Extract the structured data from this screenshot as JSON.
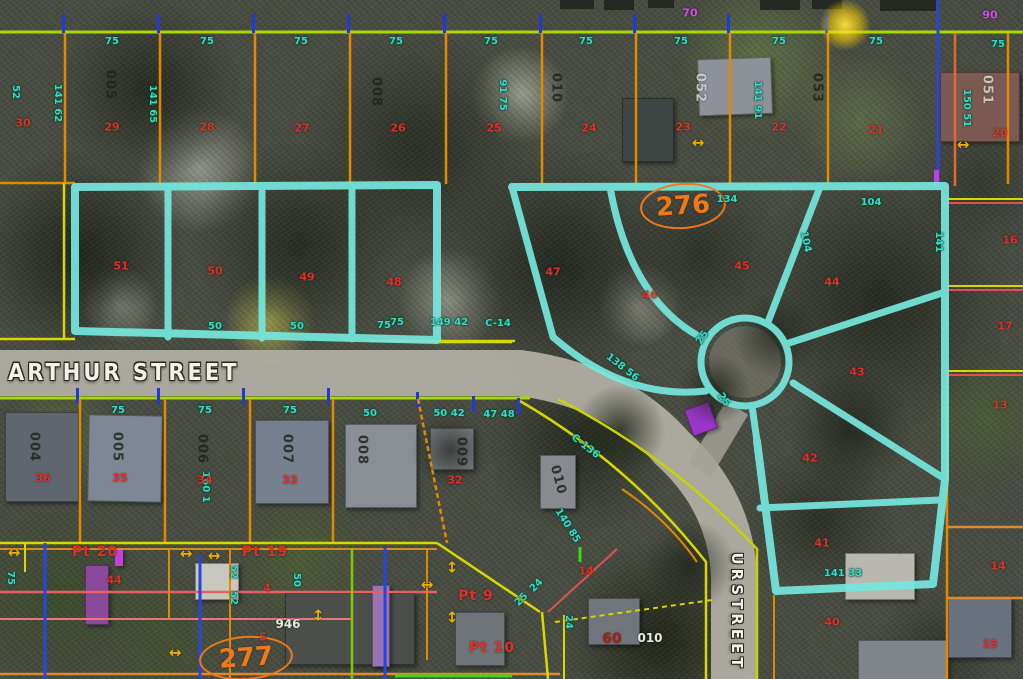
{
  "view": {
    "description": "GIS parcel map over aerial photo",
    "width": 1023,
    "height": 679
  },
  "colors": {
    "cyan_hl": "#76e8de",
    "line_orange": "#e08a00",
    "line_yellow": "#d8d800",
    "line_yellowgreen": "#a8d800",
    "line_red": "#e05050",
    "line_blue": "#2845e0",
    "text_cyan": "#3bd8cf",
    "text_red": "#e03028",
    "survey_orange": "#f07818",
    "text_purple": "#cc50e8",
    "street_gray": "#b3afa5"
  },
  "streets": {
    "arthur": "ARTHUR STREET",
    "vertical": "URSTREET"
  },
  "survey_markers": [
    {
      "text": "276"
    },
    {
      "text": "277"
    }
  ],
  "annotations": [
    {
      "t": "75",
      "x": 112,
      "y": 42,
      "k": "dim"
    },
    {
      "t": "75",
      "x": 207,
      "y": 42,
      "k": "dim"
    },
    {
      "t": "75",
      "x": 301,
      "y": 42,
      "k": "dim"
    },
    {
      "t": "75",
      "x": 396,
      "y": 42,
      "k": "dim"
    },
    {
      "t": "75",
      "x": 491,
      "y": 42,
      "k": "dim"
    },
    {
      "t": "75",
      "x": 586,
      "y": 42,
      "k": "dim"
    },
    {
      "t": "75",
      "x": 681,
      "y": 42,
      "k": "dim"
    },
    {
      "t": "75",
      "x": 779,
      "y": 42,
      "k": "dim"
    },
    {
      "t": "75",
      "x": 876,
      "y": 42,
      "k": "dim"
    },
    {
      "t": "75",
      "x": 998,
      "y": 45,
      "k": "dim"
    },
    {
      "t": "134",
      "x": 727,
      "y": 200,
      "k": "dim"
    },
    {
      "t": "104",
      "x": 871,
      "y": 203,
      "k": "dim"
    },
    {
      "t": "75",
      "x": 397,
      "y": 323,
      "k": "dim"
    },
    {
      "t": "149 42",
      "x": 449,
      "y": 323,
      "k": "dim"
    },
    {
      "t": "C-14",
      "x": 498,
      "y": 324,
      "k": "dim"
    },
    {
      "t": "50",
      "x": 215,
      "y": 327,
      "k": "dim"
    },
    {
      "t": "50",
      "x": 297,
      "y": 327,
      "k": "dim"
    },
    {
      "t": "75",
      "x": 384,
      "y": 326,
      "k": "dim"
    },
    {
      "t": "75",
      "x": 118,
      "y": 411,
      "k": "dim"
    },
    {
      "t": "75",
      "x": 205,
      "y": 411,
      "k": "dim"
    },
    {
      "t": "75",
      "x": 290,
      "y": 411,
      "k": "dim"
    },
    {
      "t": "50",
      "x": 370,
      "y": 414,
      "k": "dim"
    },
    {
      "t": "50 42",
      "x": 449,
      "y": 414,
      "k": "dim"
    },
    {
      "t": "47 48",
      "x": 499,
      "y": 415,
      "k": "dim"
    },
    {
      "t": "52",
      "x": 15,
      "y": 92,
      "k": "dim",
      "r": 90
    },
    {
      "t": "141 62",
      "x": 57,
      "y": 103,
      "k": "dim",
      "r": 90
    },
    {
      "t": "141 65",
      "x": 152,
      "y": 104,
      "k": "dim",
      "r": 90
    },
    {
      "t": "91 75",
      "x": 502,
      "y": 95,
      "k": "dim",
      "r": 90
    },
    {
      "t": "141 91",
      "x": 757,
      "y": 100,
      "k": "dim",
      "r": 90
    },
    {
      "t": "150 51",
      "x": 966,
      "y": 108,
      "k": "dim",
      "r": 90
    },
    {
      "t": "141",
      "x": 938,
      "y": 242,
      "k": "dim",
      "r": 90
    },
    {
      "t": "160 1",
      "x": 205,
      "y": 487,
      "k": "dim",
      "r": 90
    },
    {
      "t": "138 56",
      "x": 622,
      "y": 368,
      "k": "dim",
      "r": 38
    },
    {
      "t": "C-136",
      "x": 585,
      "y": 447,
      "k": "dim",
      "r": 38
    },
    {
      "t": "140 85",
      "x": 567,
      "y": 526,
      "k": "dim",
      "r": 58
    },
    {
      "t": "104",
      "x": 805,
      "y": 242,
      "k": "dim",
      "r": 78
    },
    {
      "t": "141 33",
      "x": 843,
      "y": 574,
      "k": "dim"
    },
    {
      "t": "25",
      "x": 703,
      "y": 338,
      "k": "dim",
      "r": -55
    },
    {
      "t": "25",
      "x": 723,
      "y": 400,
      "k": "dim",
      "r": 55
    },
    {
      "t": "52",
      "x": 233,
      "y": 572,
      "k": "dim",
      "r": 90
    },
    {
      "t": "52",
      "x": 233,
      "y": 598,
      "k": "dim",
      "r": 90
    },
    {
      "t": "50",
      "x": 296,
      "y": 580,
      "k": "dim",
      "r": 90
    },
    {
      "t": "75",
      "x": 10,
      "y": 578,
      "k": "dim",
      "r": 90
    },
    {
      "t": "24",
      "x": 568,
      "y": 622,
      "k": "dim",
      "r": 90
    },
    {
      "t": "25",
      "x": 522,
      "y": 600,
      "k": "dim",
      "r": -45
    },
    {
      "t": "24",
      "x": 537,
      "y": 586,
      "k": "dim",
      "r": -45
    },
    {
      "t": "30",
      "x": 23,
      "y": 123,
      "k": "lot"
    },
    {
      "t": "29",
      "x": 112,
      "y": 127,
      "k": "lot"
    },
    {
      "t": "28",
      "x": 207,
      "y": 127,
      "k": "lot"
    },
    {
      "t": "27",
      "x": 302,
      "y": 128,
      "k": "lot"
    },
    {
      "t": "26",
      "x": 398,
      "y": 128,
      "k": "lot"
    },
    {
      "t": "25",
      "x": 494,
      "y": 128,
      "k": "lot"
    },
    {
      "t": "24",
      "x": 589,
      "y": 128,
      "k": "lot"
    },
    {
      "t": "23",
      "x": 683,
      "y": 127,
      "k": "lot"
    },
    {
      "t": "22",
      "x": 779,
      "y": 127,
      "k": "lot"
    },
    {
      "t": "21",
      "x": 876,
      "y": 130,
      "k": "lot"
    },
    {
      "t": "20",
      "x": 1000,
      "y": 133,
      "k": "lot"
    },
    {
      "t": "36",
      "x": 43,
      "y": 478,
      "k": "lot"
    },
    {
      "t": "35",
      "x": 120,
      "y": 478,
      "k": "lot"
    },
    {
      "t": "34",
      "x": 205,
      "y": 480,
      "k": "lot"
    },
    {
      "t": "33",
      "x": 290,
      "y": 480,
      "k": "lot"
    },
    {
      "t": "32",
      "x": 455,
      "y": 480,
      "k": "lot"
    },
    {
      "t": "51",
      "x": 121,
      "y": 266,
      "k": "lot"
    },
    {
      "t": "50",
      "x": 215,
      "y": 271,
      "k": "lot"
    },
    {
      "t": "49",
      "x": 307,
      "y": 277,
      "k": "lot"
    },
    {
      "t": "48",
      "x": 394,
      "y": 282,
      "k": "lot"
    },
    {
      "t": "47",
      "x": 553,
      "y": 272,
      "k": "lot"
    },
    {
      "t": "46",
      "x": 650,
      "y": 295,
      "k": "lot"
    },
    {
      "t": "45",
      "x": 742,
      "y": 266,
      "k": "lot"
    },
    {
      "t": "44",
      "x": 832,
      "y": 282,
      "k": "lot"
    },
    {
      "t": "43",
      "x": 857,
      "y": 372,
      "k": "lot"
    },
    {
      "t": "42",
      "x": 810,
      "y": 458,
      "k": "lot"
    },
    {
      "t": "41",
      "x": 822,
      "y": 543,
      "k": "lot"
    },
    {
      "t": "40",
      "x": 832,
      "y": 622,
      "k": "lot"
    },
    {
      "t": "16",
      "x": 1010,
      "y": 240,
      "k": "lot"
    },
    {
      "t": "17",
      "x": 1005,
      "y": 326,
      "k": "lot"
    },
    {
      "t": "13",
      "x": 1000,
      "y": 405,
      "k": "lot"
    },
    {
      "t": "14",
      "x": 998,
      "y": 566,
      "k": "lot"
    },
    {
      "t": "15",
      "x": 990,
      "y": 644,
      "k": "lot"
    },
    {
      "t": "4",
      "x": 267,
      "y": 588,
      "k": "lot"
    },
    {
      "t": "5",
      "x": 263,
      "y": 637,
      "k": "lot"
    },
    {
      "t": "44",
      "x": 114,
      "y": 580,
      "k": "lot"
    },
    {
      "t": "14",
      "x": 586,
      "y": 571,
      "k": "lot"
    },
    {
      "t": "60",
      "x": 612,
      "y": 639,
      "k": "red2"
    },
    {
      "t": "Pt 20",
      "x": 95,
      "y": 552,
      "k": "pt"
    },
    {
      "t": "Pt 19",
      "x": 265,
      "y": 552,
      "k": "pt"
    },
    {
      "t": "Pt 9",
      "x": 476,
      "y": 596,
      "k": "pt"
    },
    {
      "t": "Pt 10",
      "x": 492,
      "y": 648,
      "k": "pt"
    },
    {
      "t": "005",
      "x": 110,
      "y": 85,
      "k": "pid",
      "r": 90
    },
    {
      "t": "008",
      "x": 376,
      "y": 92,
      "k": "pid",
      "r": 90
    },
    {
      "t": "010",
      "x": 556,
      "y": 88,
      "k": "pid",
      "r": 90
    },
    {
      "t": "053",
      "x": 817,
      "y": 88,
      "k": "pid",
      "r": 90
    },
    {
      "t": "052",
      "x": 700,
      "y": 88,
      "k": "pidw",
      "r": 90
    },
    {
      "t": "051",
      "x": 987,
      "y": 90,
      "k": "pidw",
      "r": 90
    },
    {
      "t": "004",
      "x": 34,
      "y": 447,
      "k": "pid",
      "r": 90
    },
    {
      "t": "005",
      "x": 117,
      "y": 447,
      "k": "pid",
      "r": 90
    },
    {
      "t": "006",
      "x": 202,
      "y": 449,
      "k": "pid",
      "r": 90
    },
    {
      "t": "007",
      "x": 287,
      "y": 449,
      "k": "pid",
      "r": 90
    },
    {
      "t": "008",
      "x": 362,
      "y": 450,
      "k": "pid",
      "r": 90
    },
    {
      "t": "009",
      "x": 461,
      "y": 452,
      "k": "pid",
      "r": 90
    },
    {
      "t": "010",
      "x": 558,
      "y": 480,
      "k": "pid",
      "r": 75
    },
    {
      "t": "946",
      "x": 288,
      "y": 624,
      "k": "white"
    },
    {
      "t": "010",
      "x": 650,
      "y": 638,
      "k": "white"
    },
    {
      "t": "70",
      "x": 690,
      "y": 13,
      "k": "purple"
    },
    {
      "t": "90",
      "x": 990,
      "y": 15,
      "k": "purple"
    },
    {
      "t": "↔",
      "x": 698,
      "y": 143,
      "k": "arrow"
    },
    {
      "t": "↔",
      "x": 963,
      "y": 145,
      "k": "arrow"
    },
    {
      "t": "↔",
      "x": 14,
      "y": 553,
      "k": "arrow"
    },
    {
      "t": "↔",
      "x": 186,
      "y": 554,
      "k": "arrow"
    },
    {
      "t": "↔",
      "x": 214,
      "y": 556,
      "k": "arrow"
    },
    {
      "t": "↔",
      "x": 427,
      "y": 585,
      "k": "arrow"
    },
    {
      "t": "↔",
      "x": 175,
      "y": 653,
      "k": "arrow"
    },
    {
      "t": "↕",
      "x": 318,
      "y": 616,
      "k": "arrow"
    },
    {
      "t": "↕",
      "x": 452,
      "y": 568,
      "k": "arrow"
    },
    {
      "t": "↕",
      "x": 452,
      "y": 618,
      "k": "arrow"
    }
  ]
}
